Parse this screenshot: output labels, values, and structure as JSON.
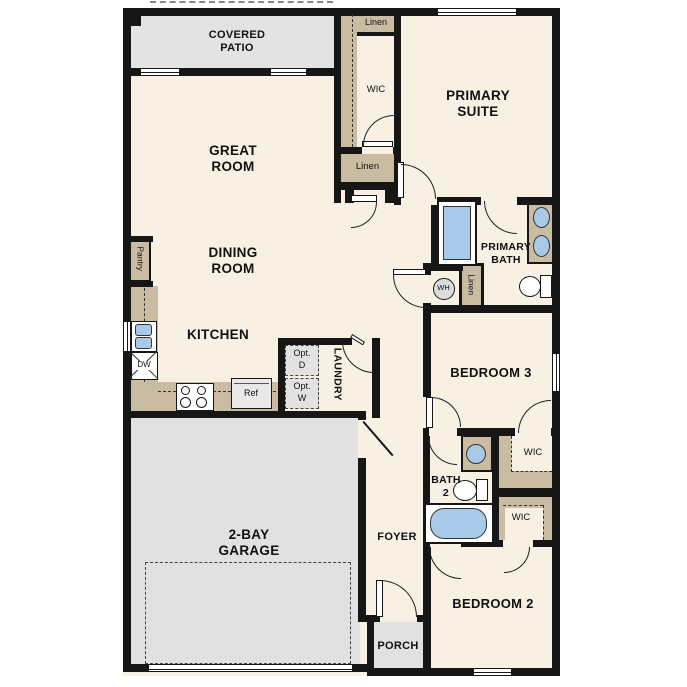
{
  "title": "single-story floor plan",
  "colors": {
    "wall": "#161616",
    "floor": "#f7f0e3",
    "outdoor_gray": "#e3e3e3",
    "cabinet_tan": "#cabba3",
    "fixture_blue": "#a9c9e9"
  },
  "labels": {
    "covered_patio_1": "COVERED",
    "covered_patio_2": "PATIO",
    "great_room_1": "GREAT",
    "great_room_2": "ROOM",
    "primary_suite_1": "PRIMARY",
    "primary_suite_2": "SUITE",
    "dining_room_1": "DINING",
    "dining_room_2": "ROOM",
    "kitchen": "KITCHEN",
    "primary_bath_1": "PRIMARY",
    "primary_bath_2": "BATH",
    "bedroom3": "BEDROOM 3",
    "bath2_1": "BATH",
    "bath2_2": "2",
    "laundry": "LAUNDRY",
    "garage_1": "2-BAY",
    "garage_2": "GARAGE",
    "foyer": "FOYER",
    "porch": "PORCH",
    "bedroom2": "BEDROOM 2",
    "wic_primary": "WIC",
    "wic_bed3": "WIC",
    "wic_bed2": "WIC",
    "linen_top": "Linen",
    "linen_hall": "Linen",
    "linen_bath": "Linen",
    "pantry": "Pantry",
    "opt_d_1": "Opt.",
    "opt_d_2": "D",
    "opt_w_1": "Opt.",
    "opt_w_2": "W",
    "ref": "Ref",
    "dw": "DW",
    "wh": "WH"
  }
}
